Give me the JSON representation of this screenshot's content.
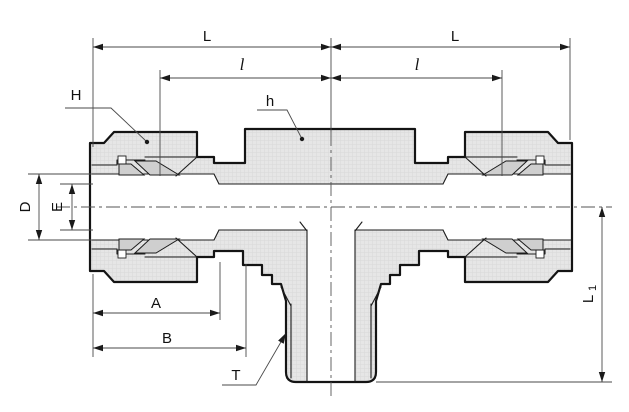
{
  "drawing": {
    "labels": {
      "L_left": "L",
      "L_right": "L",
      "l_left": "l",
      "l_right": "l",
      "H": "H",
      "h": "h",
      "D": "D",
      "E": "E",
      "A": "A",
      "B": "B",
      "T": "T",
      "L1_base": "L",
      "L1_sub": "1"
    },
    "colors": {
      "background": "#ffffff",
      "body_fill": "#e6e6e6",
      "texture_line": "#d8d8d8",
      "ferrule_fill": "#cfcfcf",
      "outline": "#141414",
      "dimension_line": "#4a4a4a",
      "text": "#111111"
    }
  }
}
